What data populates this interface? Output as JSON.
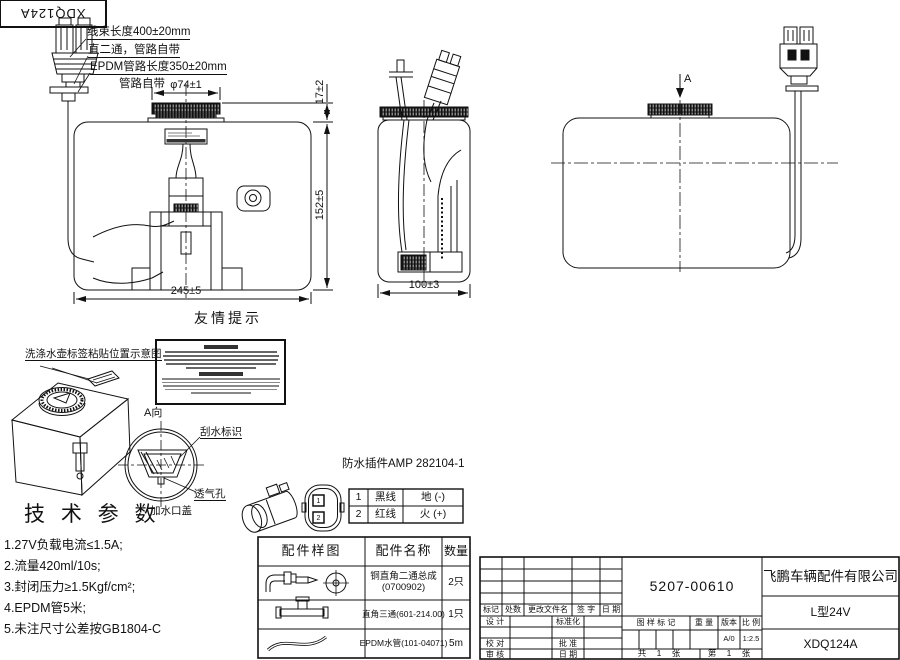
{
  "corner": {
    "code": "XDQ124A"
  },
  "callouts": {
    "l1": "线束长度400±20mm",
    "l2": "直二通，管路自带",
    "l3": "EPDM管路长度350±20mm",
    "l4": "管路自带",
    "label_pos": "洗涤水壶标签粘贴位置示意图",
    "reminder_title": "友情提示"
  },
  "dims": {
    "cap_dia": "φ74±1",
    "cap_h": "17±2",
    "height": "152±5",
    "width": "245±5",
    "depth": "100±3"
  },
  "view_a": {
    "arrow": "A",
    "label": "A向",
    "wiper": "刮水标识",
    "vent": "透气孔",
    "filler_cap": "加水口盖"
  },
  "tech": {
    "title": "技 术 参 数",
    "items": [
      "1.27V负载电流≤1.5A;",
      "2.流量420ml/10s;",
      "3.封闭压力≥1.5Kgf/cm²;",
      "4.EPDM管5米;",
      "5.未注尺寸公差按GB1804-C"
    ]
  },
  "connector": {
    "title": "防水插件AMP 282104-1",
    "pins": [
      {
        "no": "1",
        "wire": "黑线",
        "polarity": "地 (-)"
      },
      {
        "no": "2",
        "wire": "红线",
        "polarity": "火 (+)"
      }
    ],
    "face_pins": [
      "1",
      "2"
    ]
  },
  "parts": {
    "headers": [
      "配件样图",
      "配件名称",
      "数量"
    ],
    "rows": [
      {
        "name": "铜直角二通总成",
        "name2": "(0700902)",
        "qty": "2只"
      },
      {
        "name": "直角三通(601-214.00)",
        "name2": "",
        "qty": "1只"
      },
      {
        "name": "EPDM水管(101-04071)",
        "name2": "",
        "qty": "5m"
      }
    ]
  },
  "tb": {
    "drawing_no": "5207-00610",
    "company": "飞鹏车辆配件有限公司",
    "model": "L型24V",
    "part_no": "XDQ124A",
    "rev": [
      "标记",
      "处数",
      "更改文件名",
      "签 字",
      "日 期"
    ],
    "sig": {
      "design": "设 计",
      "std": "标准化",
      "check": "校 对",
      "approve": "批 准",
      "audit": "审 核",
      "date": "日 期"
    },
    "stamp": [
      "图 样 标 记",
      "重 量",
      "版本",
      "比 例"
    ],
    "version": "A/0",
    "scale": "1:2.5",
    "sheets_total": "共 1 张",
    "sheet_no": "第 1 张"
  }
}
